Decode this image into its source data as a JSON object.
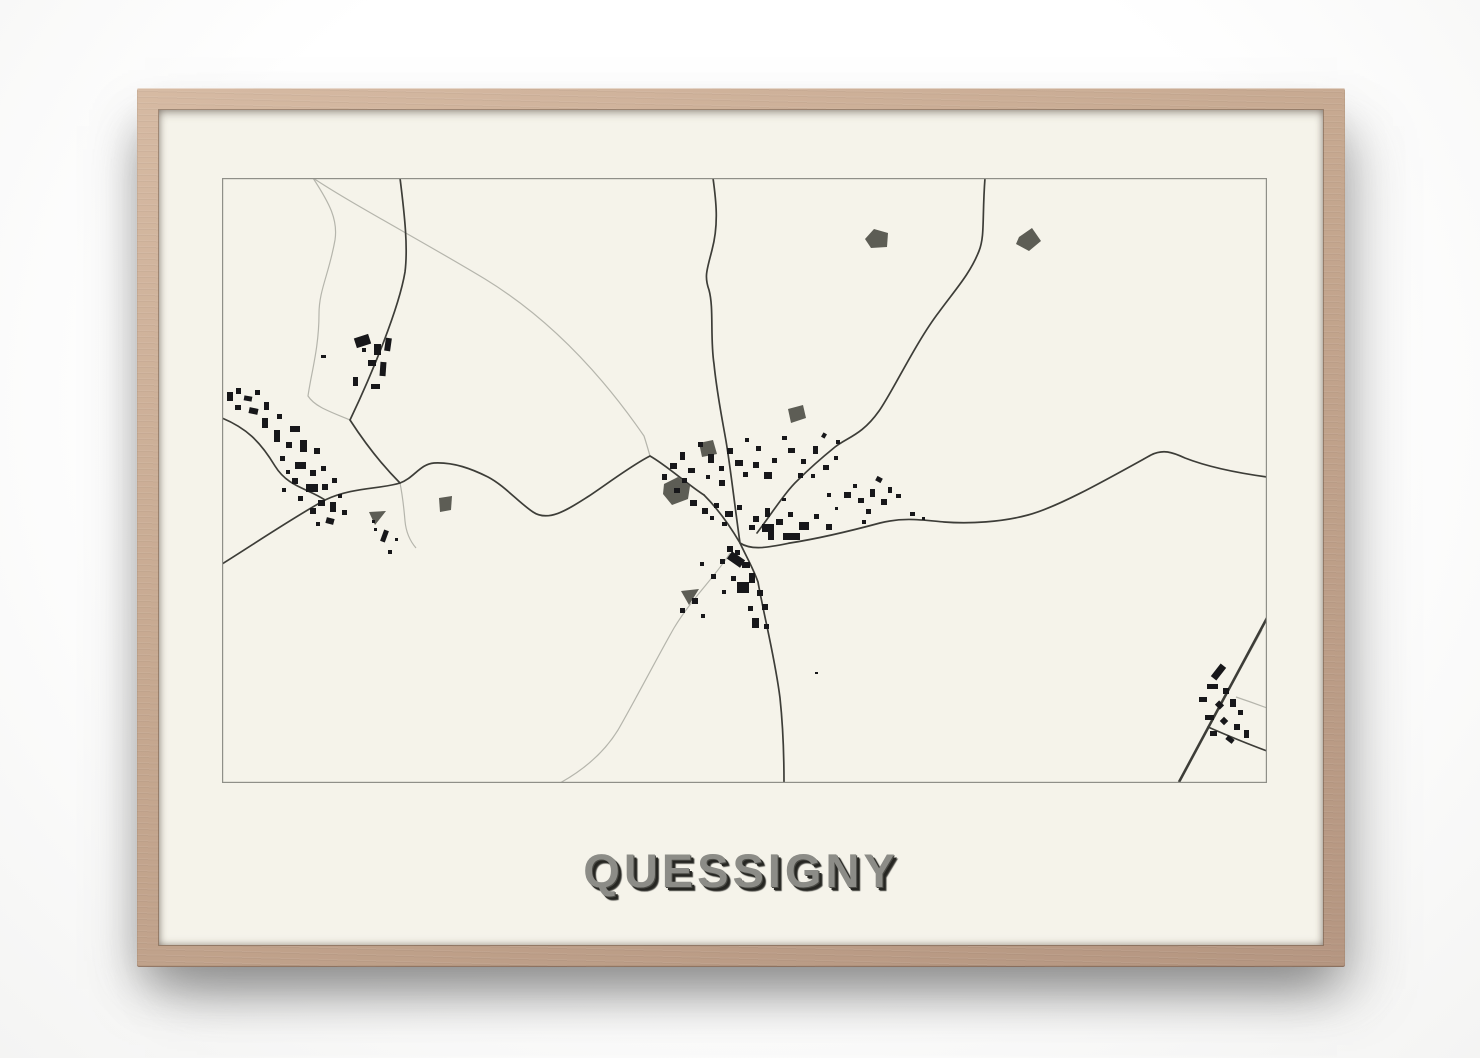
{
  "poster": {
    "title": "QUESSIGNY",
    "title_color": "#8c8c87",
    "title_shadow_color": "#262622",
    "paper_color": "#f5f3ea"
  },
  "frame": {
    "wood_light": "#d6baa3",
    "wood_mid": "#c5a78f",
    "wood_dark": "#b59681"
  },
  "map_data": {
    "type": "map",
    "width": 1045,
    "height": 605,
    "colors": {
      "paper": "#f5f3ea",
      "border": "#8f8f88",
      "road_dark": "#3d3d38",
      "road_light": "#b5b5ac",
      "building": "#17171a",
      "blob": "#5d5d55"
    },
    "roads_light": [
      "M91,0 C108,26 116,42 113,62 C107,96 97,112 97,136 C97,170 89,196 86,218 C93,229 109,234 128,242",
      "M91,0 C130,26 200,63 263,101 C330,142 382,200 422,258 C424,264 426,271 428,278",
      "M178,305 C181,320 182,331 183,343 C184,354 188,363 194,370",
      "M508,375 C494,398 470,420 452,450 C436,478 416,517 396,552 C380,578 356,595 338,605",
      "M1040,452 L988,546",
      "M1014,519 C1026,523 1037,527 1045,530"
    ],
    "roads_dark": [
      "M178,0 C183,40 186,70 183,94 C177,130 150,196 128,242 C139,259 157,284 178,305",
      "M0,240 C24,250 38,263 53,288 C66,309 85,310 103,322",
      "M0,386 C32,366 72,339 103,322 C130,309 160,311 178,305 C192,300 198,286 212,285 C232,284 250,291 266,299 C283,308 296,324 311,334 C327,345 348,330 367,318 C385,306 410,287 428,278 C444,287 465,306 482,317",
      "M482,317 C496,331 508,348 518,365 C530,373 548,369 568,365 C600,360 632,352 658,345 C682,339 700,342 722,344 C748,346 780,344 806,337 C836,329 882,303 929,277 C941,271 950,274 963,280 C986,289 1016,295 1045,299",
      "M763,0 C760,40 763,58 757,73 C748,96 733,112 717,134 C694,164 671,213 657,233 C640,257 626,259 613,269 C597,282 585,293 576,302 C564,313 550,335 535,355",
      "M518,365 C524,378 531,390 536,404 C542,438 553,480 558,520 C561,548 562,580 562,605",
      "M491,0 C494,22 497,46 490,72 C485,92 482,98 487,112 C492,130 488,160 492,186 C495,216 500,240 504,263 C508,286 513,330 518,365",
      "M986,549 C1002,556 1026,566 1045,573"
    ],
    "railway": {
      "d": "M1045,440 L957,604",
      "width": 2.6
    },
    "blobs": [
      "652,51 666,55 665,69 649,70 643,61",
      "797,59 810,50 819,63 807,73 794,66",
      "566,231 581,227 584,240 569,245",
      "477,265 491,262 495,276 480,279",
      "442,306 456,299 468,308 466,321 450,327 441,316",
      "217,320 230,318 229,332 218,334",
      "147,334 164,333 153,347",
      "459,413 477,411 467,427"
    ],
    "buildings": [
      [
        133,
        158,
        15,
        10,
        -18
      ],
      [
        152,
        166,
        7,
        11,
        0
      ],
      [
        163,
        160,
        6,
        13,
        8
      ],
      [
        146,
        182,
        8,
        6,
        0
      ],
      [
        158,
        184,
        6,
        14,
        4
      ],
      [
        131,
        199,
        5,
        9,
        0
      ],
      [
        149,
        206,
        9,
        5,
        0
      ],
      [
        140,
        170,
        4,
        4,
        0
      ],
      [
        99,
        177,
        5,
        3,
        0
      ],
      [
        5,
        214,
        6,
        9,
        0
      ],
      [
        14,
        210,
        5,
        6,
        0
      ],
      [
        22,
        218,
        8,
        5,
        10
      ],
      [
        33,
        212,
        5,
        5,
        0
      ],
      [
        13,
        227,
        6,
        5,
        0
      ],
      [
        27,
        230,
        9,
        6,
        12
      ],
      [
        42,
        224,
        5,
        8,
        0
      ],
      [
        40,
        240,
        6,
        10,
        0
      ],
      [
        55,
        236,
        5,
        5,
        0
      ],
      [
        52,
        252,
        6,
        12,
        0
      ],
      [
        68,
        248,
        10,
        6,
        0
      ],
      [
        64,
        264,
        6,
        6,
        0
      ],
      [
        78,
        262,
        7,
        12,
        0
      ],
      [
        92,
        270,
        6,
        6,
        0
      ],
      [
        58,
        278,
        5,
        5,
        0
      ],
      [
        73,
        284,
        11,
        7,
        0
      ],
      [
        88,
        292,
        6,
        6,
        0
      ],
      [
        99,
        288,
        5,
        5,
        0
      ],
      [
        70,
        300,
        6,
        6,
        0
      ],
      [
        84,
        306,
        12,
        8,
        0
      ],
      [
        100,
        306,
        6,
        6,
        0
      ],
      [
        110,
        300,
        5,
        5,
        0
      ],
      [
        96,
        322,
        7,
        6,
        0
      ],
      [
        108,
        324,
        6,
        10,
        0
      ],
      [
        88,
        330,
        6,
        6,
        0
      ],
      [
        76,
        318,
        5,
        5,
        0
      ],
      [
        60,
        310,
        4,
        4,
        0
      ],
      [
        116,
        316,
        4,
        4,
        0
      ],
      [
        104,
        340,
        8,
        6,
        15
      ],
      [
        94,
        344,
        4,
        4,
        0
      ],
      [
        120,
        332,
        5,
        5,
        0
      ],
      [
        64,
        292,
        4,
        4,
        0
      ],
      [
        160,
        352,
        5,
        12,
        20
      ],
      [
        152,
        350,
        3,
        3,
        0
      ],
      [
        166,
        372,
        4,
        4,
        0
      ],
      [
        150,
        342,
        3,
        3,
        0
      ],
      [
        173,
        360,
        3,
        3,
        0
      ],
      [
        448,
        285,
        7,
        6,
        0
      ],
      [
        458,
        274,
        5,
        8,
        0
      ],
      [
        466,
        290,
        7,
        5,
        0
      ],
      [
        476,
        264,
        5,
        5,
        0
      ],
      [
        486,
        276,
        6,
        9,
        0
      ],
      [
        497,
        288,
        5,
        5,
        0
      ],
      [
        505,
        270,
        6,
        6,
        0
      ],
      [
        513,
        282,
        8,
        6,
        0
      ],
      [
        521,
        294,
        5,
        5,
        0
      ],
      [
        531,
        284,
        6,
        6,
        0
      ],
      [
        542,
        294,
        8,
        7,
        0
      ],
      [
        550,
        280,
        5,
        5,
        0
      ],
      [
        534,
        268,
        5,
        5,
        0
      ],
      [
        523,
        260,
        4,
        4,
        0
      ],
      [
        497,
        302,
        6,
        6,
        0
      ],
      [
        484,
        297,
        4,
        4,
        0
      ],
      [
        460,
        300,
        5,
        5,
        0
      ],
      [
        440,
        296,
        5,
        6,
        0
      ],
      [
        452,
        310,
        6,
        5,
        0
      ],
      [
        566,
        270,
        7,
        5,
        0
      ],
      [
        579,
        281,
        5,
        5,
        0
      ],
      [
        591,
        268,
        5,
        8,
        0
      ],
      [
        601,
        287,
        6,
        5,
        0
      ],
      [
        576,
        295,
        5,
        5,
        0
      ],
      [
        612,
        278,
        4,
        4,
        0
      ],
      [
        589,
        296,
        4,
        4,
        0
      ],
      [
        560,
        258,
        5,
        4,
        0
      ],
      [
        600,
        255,
        4,
        5,
        30
      ],
      [
        614,
        262,
        4,
        4,
        0
      ],
      [
        468,
        322,
        7,
        6,
        0
      ],
      [
        480,
        330,
        6,
        6,
        0
      ],
      [
        492,
        325,
        5,
        5,
        0
      ],
      [
        503,
        333,
        8,
        6,
        0
      ],
      [
        515,
        327,
        5,
        5,
        0
      ],
      [
        531,
        338,
        6,
        6,
        0
      ],
      [
        543,
        330,
        5,
        9,
        0
      ],
      [
        554,
        341,
        7,
        6,
        0
      ],
      [
        566,
        334,
        5,
        5,
        0
      ],
      [
        592,
        336,
        5,
        5,
        0
      ],
      [
        604,
        346,
        6,
        6,
        0
      ],
      [
        546,
        356,
        5,
        5,
        0
      ],
      [
        500,
        344,
        5,
        4,
        0
      ],
      [
        488,
        338,
        4,
        4,
        0
      ],
      [
        540,
        346,
        12,
        8,
        0
      ],
      [
        546,
        354,
        6,
        8,
        0
      ],
      [
        561,
        355,
        17,
        7,
        0
      ],
      [
        577,
        344,
        10,
        8,
        0
      ],
      [
        527,
        347,
        6,
        5,
        0
      ],
      [
        505,
        368,
        6,
        6,
        0
      ],
      [
        513,
        372,
        5,
        5,
        0
      ],
      [
        520,
        384,
        8,
        6,
        0
      ],
      [
        498,
        381,
        5,
        5,
        0
      ],
      [
        527,
        395,
        6,
        10,
        0
      ],
      [
        509,
        398,
        5,
        5,
        0
      ],
      [
        535,
        412,
        6,
        6,
        0
      ],
      [
        515,
        404,
        12,
        11,
        0
      ],
      [
        540,
        426,
        6,
        6,
        0
      ],
      [
        500,
        412,
        4,
        4,
        0
      ],
      [
        489,
        396,
        5,
        5,
        0
      ],
      [
        478,
        384,
        4,
        4,
        0
      ],
      [
        530,
        440,
        7,
        10,
        0
      ],
      [
        542,
        446,
        5,
        5,
        0
      ],
      [
        506,
        377,
        16,
        9,
        35
      ],
      [
        526,
        428,
        5,
        5,
        0
      ],
      [
        470,
        420,
        6,
        6,
        0
      ],
      [
        458,
        430,
        5,
        5,
        0
      ],
      [
        479,
        436,
        4,
        4,
        0
      ],
      [
        622,
        314,
        7,
        6,
        0
      ],
      [
        636,
        320,
        6,
        5,
        0
      ],
      [
        648,
        311,
        5,
        8,
        0
      ],
      [
        659,
        321,
        6,
        6,
        0
      ],
      [
        644,
        331,
        5,
        5,
        0
      ],
      [
        631,
        306,
        4,
        4,
        0
      ],
      [
        654,
        299,
        6,
        5,
        28
      ],
      [
        666,
        309,
        4,
        6,
        0
      ],
      [
        674,
        316,
        5,
        4,
        0
      ],
      [
        640,
        342,
        4,
        4,
        0
      ],
      [
        688,
        334,
        5,
        4,
        0
      ],
      [
        700,
        339,
        3,
        3,
        0
      ],
      [
        605,
        315,
        4,
        4,
        0
      ],
      [
        613,
        329,
        3,
        3,
        0
      ],
      [
        560,
        320,
        4,
        3,
        0
      ],
      [
        593,
        494,
        3,
        2,
        0
      ],
      [
        993,
        486,
        7,
        16,
        38
      ],
      [
        985,
        506,
        11,
        5,
        0
      ],
      [
        1001,
        510,
        6,
        6,
        0
      ],
      [
        977,
        519,
        8,
        5,
        0
      ],
      [
        994,
        524,
        7,
        6,
        45
      ],
      [
        1008,
        521,
        6,
        8,
        0
      ],
      [
        983,
        537,
        9,
        5,
        0
      ],
      [
        999,
        540,
        6,
        6,
        45
      ],
      [
        1012,
        546,
        6,
        6,
        0
      ],
      [
        988,
        553,
        7,
        5,
        0
      ],
      [
        1004,
        559,
        8,
        5,
        38
      ],
      [
        1016,
        532,
        5,
        5,
        0
      ],
      [
        1022,
        552,
        5,
        8,
        0
      ]
    ]
  }
}
